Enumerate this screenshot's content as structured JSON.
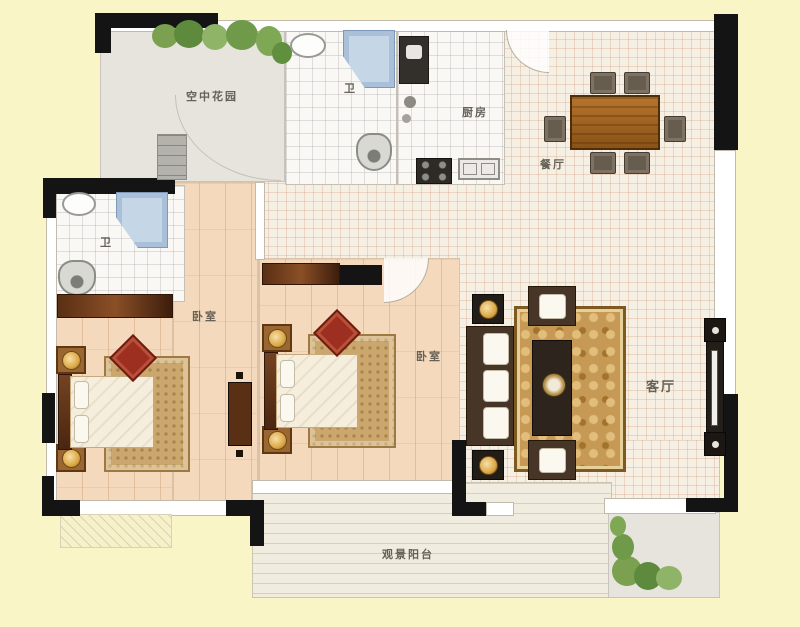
{
  "title": "apartment-floor-plan",
  "colors": {
    "background": "#faf5c6",
    "wall": "#141414",
    "floor_wood": "#f4d9bd",
    "floor_tile_cream": "#f6efe3",
    "floor_tile_white": "#f9f8f5",
    "rug_gold": "#c69a54",
    "rug_tan": "#cba76e",
    "furniture_wood": "#8a4f26",
    "shower_blue": "#c5d6e7",
    "cushion_red": "#9c2f1f",
    "greenery": "#6f9a4a"
  },
  "rooms": {
    "sky_garden": {
      "label": "空中花园"
    },
    "bath_top": {
      "label": "卫"
    },
    "kitchen": {
      "label": "厨房"
    },
    "dining": {
      "label": "餐厅"
    },
    "bath_left": {
      "label": "卫"
    },
    "bedroom_left": {
      "label": "卧室"
    },
    "bedroom_middle": {
      "label": "卧室"
    },
    "living": {
      "label": "客厅"
    },
    "balcony": {
      "label": "观景阳台"
    }
  }
}
